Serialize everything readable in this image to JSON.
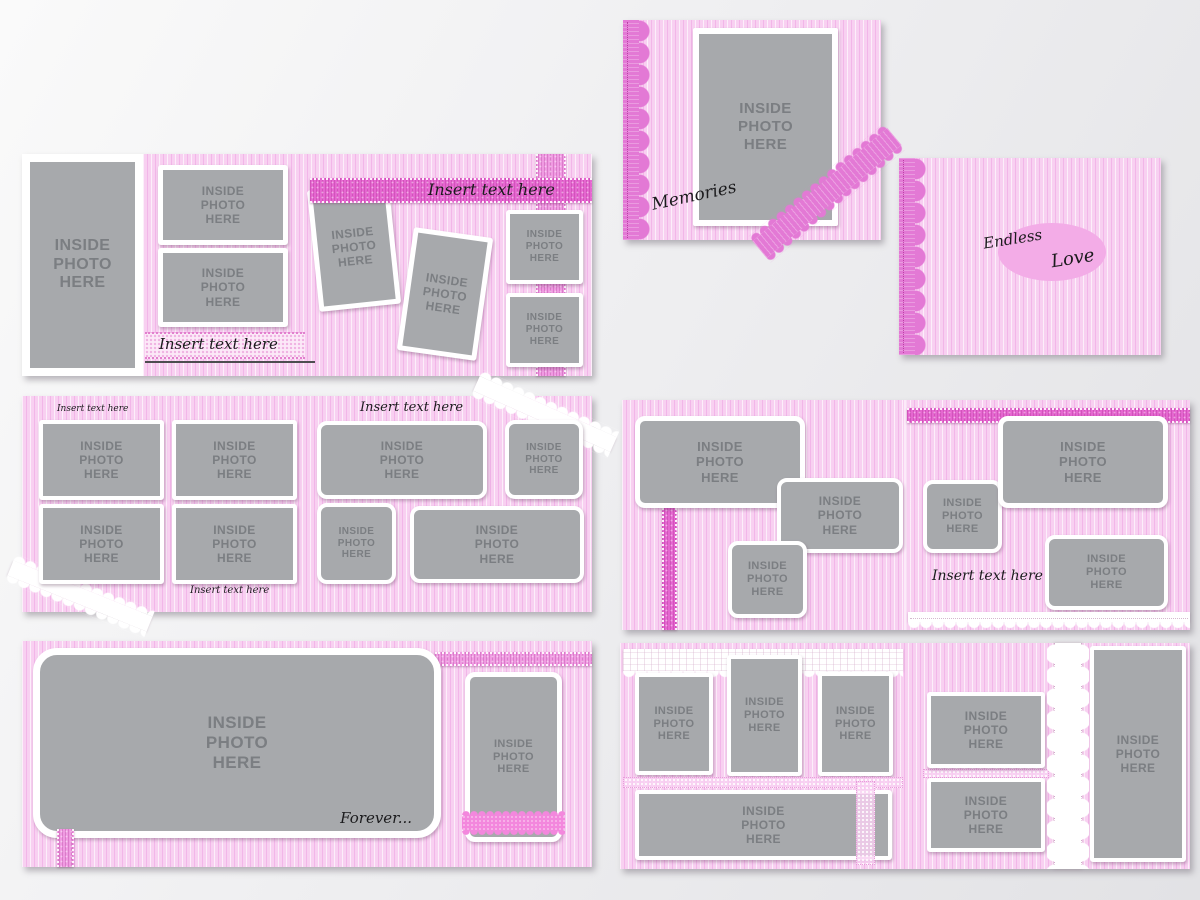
{
  "labels": {
    "inside_photo": "INSIDE\nPHOTO\nHERE",
    "insert_text": "Insert text here"
  },
  "covers": {
    "memories": {
      "title": "Memories"
    },
    "endless_love": {
      "title_line1": "Endless",
      "title_line2": "Love"
    }
  },
  "captions": {
    "forever": "Forever..."
  },
  "colors": {
    "accent_magenta": "#e566d0",
    "ribbon_light": "#f09ae2",
    "scallop_pink": "#e379d5",
    "oval_pink": "#f3ace7",
    "stripe_base": "#f8d0f1",
    "placeholder_gray": "#a7a9ac",
    "placeholder_text": "#7b7e82",
    "script_ink": "#1b1b1d",
    "canvas_light": "#fafafa",
    "canvas_dark": "#e2e2e5"
  }
}
